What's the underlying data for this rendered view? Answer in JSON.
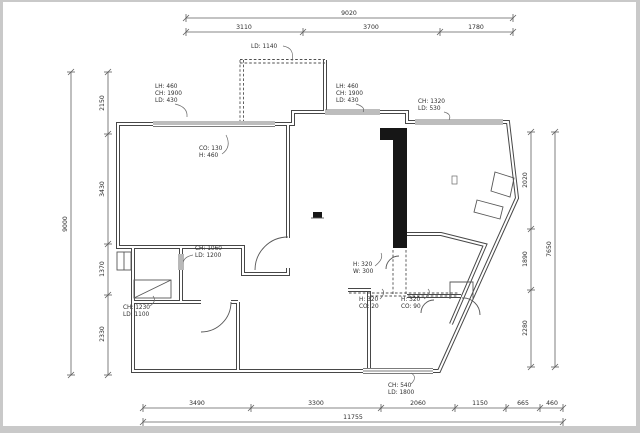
{
  "drawing": {
    "type": "apartment floor plan",
    "ink_color": "#474747",
    "background": "#ffffff",
    "frame_color": "#c9c9c9"
  },
  "dimensions": {
    "top": {
      "total": "9020",
      "segments": [
        "3110",
        "3700",
        "1780"
      ]
    },
    "left": {
      "total": "9000",
      "segments": [
        "2150",
        "3430",
        "1370",
        "2330"
      ]
    },
    "right": {
      "total": "7650",
      "segments": [
        "2020",
        "1890",
        "2280"
      ]
    },
    "bottom": {
      "total": "11755",
      "segments": [
        "3490",
        "3300",
        "2060",
        "1150",
        "665",
        "460"
      ]
    }
  },
  "annotations": {
    "balcony_depth": {
      "l1": "LD: 1140"
    },
    "window_left": {
      "l1": "LH: 460",
      "l2": "CH: 1900",
      "l3": "LD: 430"
    },
    "window_mid": {
      "l1": "LH: 460",
      "l2": "CH: 1900",
      "l3": "LD: 430"
    },
    "window_right": {
      "l1": "CH: 1320",
      "l2": "LD: 530"
    },
    "sill": {
      "l1": "CO: 130",
      "l2": "H: 460"
    },
    "pass_through": {
      "l1": "CH: 1060",
      "l2": "LD: 1200"
    },
    "kitchen_window": {
      "l1": "CH: 1230",
      "l2": "LD: 1100"
    },
    "bath_niche": {
      "l1": "H: 320",
      "l2": "W: 300"
    },
    "bath_opening_a": {
      "l1": "H: 320",
      "l2": "CO: 20"
    },
    "bath_opening_b": {
      "l1": "H: 320",
      "l2": "CO: 90"
    },
    "bottom_window": {
      "l1": "CH: 540",
      "l2": "LD: 1800"
    }
  }
}
